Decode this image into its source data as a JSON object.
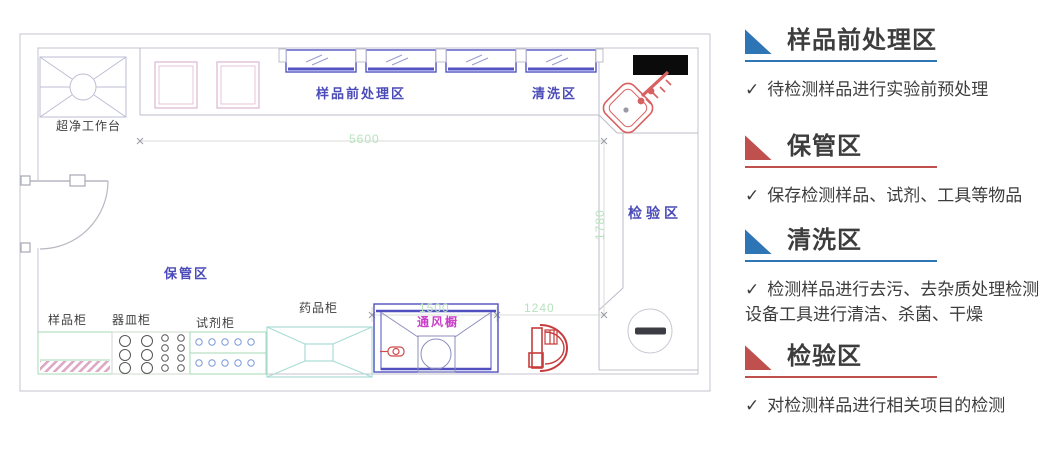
{
  "plan": {
    "zone_labels": {
      "pretreatment": "样品前处理区",
      "cleaning": "清洗区",
      "inspection": "检验区",
      "storage": "保管区"
    },
    "equipment_labels": {
      "clean_bench": "超净工作台",
      "fume_hood": "通风橱",
      "sample_cabinet": "样品柜",
      "vessel_cabinet": "器皿柜",
      "reagent_cabinet": "试剂柜",
      "medicine_cabinet": "药品柜"
    },
    "dimensions": {
      "top_width": "5600",
      "right_height": "1780",
      "fume_hood_width": "1500",
      "right_section_width": "1240"
    },
    "colors": {
      "zone_label": "#4a4ab8",
      "dimension_text": "#b7e3bd",
      "window_blue": "#5353c6",
      "cabinet_green": "#a5d9b5",
      "medicine_teal": "#a9dcd4",
      "sink_pink": "#dcb6d0",
      "red_fixture": "#cf4a4a",
      "fume_hood_label": "#c93fc9",
      "wall_gray": "#c3c3cf"
    }
  },
  "panel": {
    "check_glyph": "✓",
    "sections": [
      {
        "title": "样品前处理区",
        "color": "#2e75b6",
        "bullet": "待检测样品进行实验前预处理"
      },
      {
        "title": "保管区",
        "color": "#c0504d",
        "bullet": "保存检测样品、试剂、工具等物品"
      },
      {
        "title": "清洗区",
        "color": "#2e75b6",
        "bullet": "检测样品进行去污、去杂质处理检测设备工具进行清洁、杀菌、干燥"
      },
      {
        "title": "检验区",
        "color": "#c0504d",
        "bullet": "对检测样品进行相关项目的检测"
      }
    ]
  }
}
